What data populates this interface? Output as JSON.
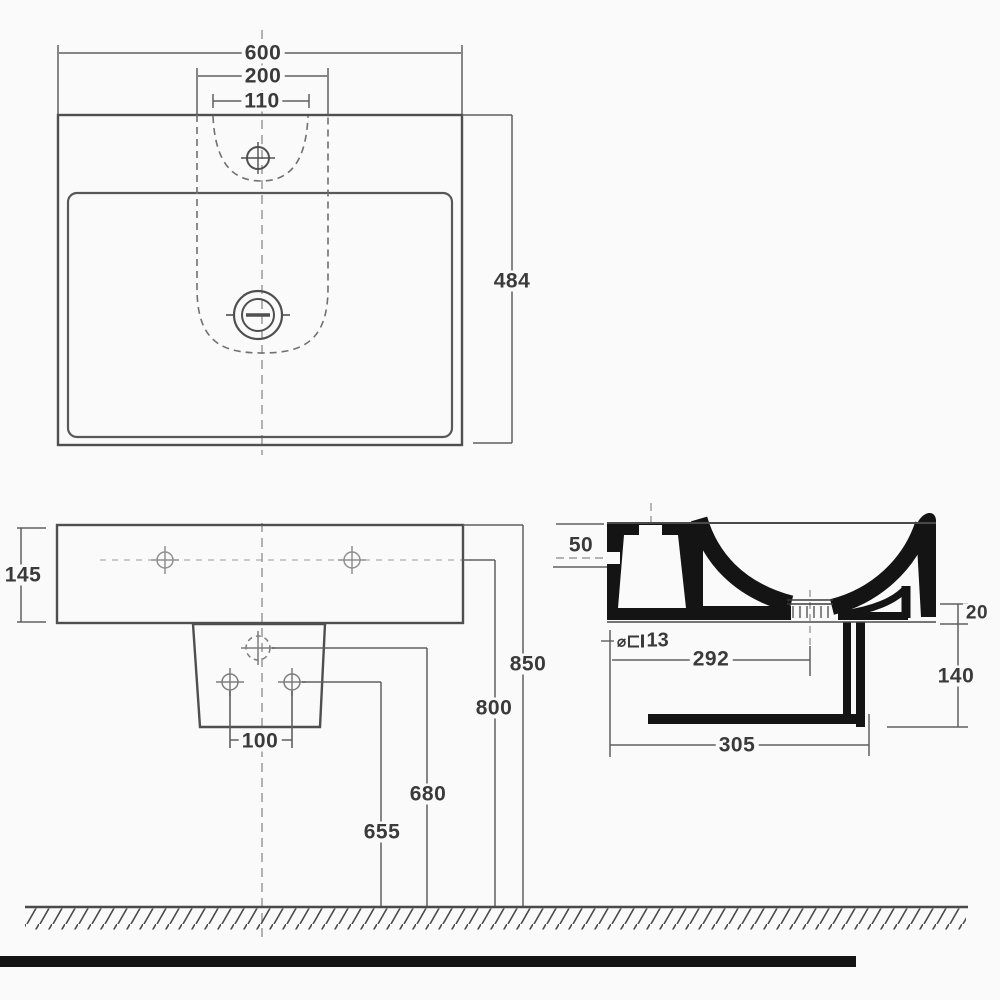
{
  "dims": {
    "top": {
      "width": "600",
      "inner_width": "200",
      "tap_span": "110",
      "depth": "484"
    },
    "front": {
      "height": "145",
      "bolt_span": "100",
      "h655": "655",
      "h680": "680",
      "h800": "800",
      "h850": "850"
    },
    "section": {
      "top_inset": "50",
      "fixing_symbol": "⌀",
      "fixing_size": "13",
      "drain_from_wall": "292",
      "apron": "20",
      "drop": "140",
      "projection": "305"
    }
  },
  "colors": {
    "background": "#fafafa",
    "outline": "#4a4a4a",
    "dim_line": "#5f5f5f",
    "text": "#3a3a3a",
    "section_fill": "#141414"
  }
}
